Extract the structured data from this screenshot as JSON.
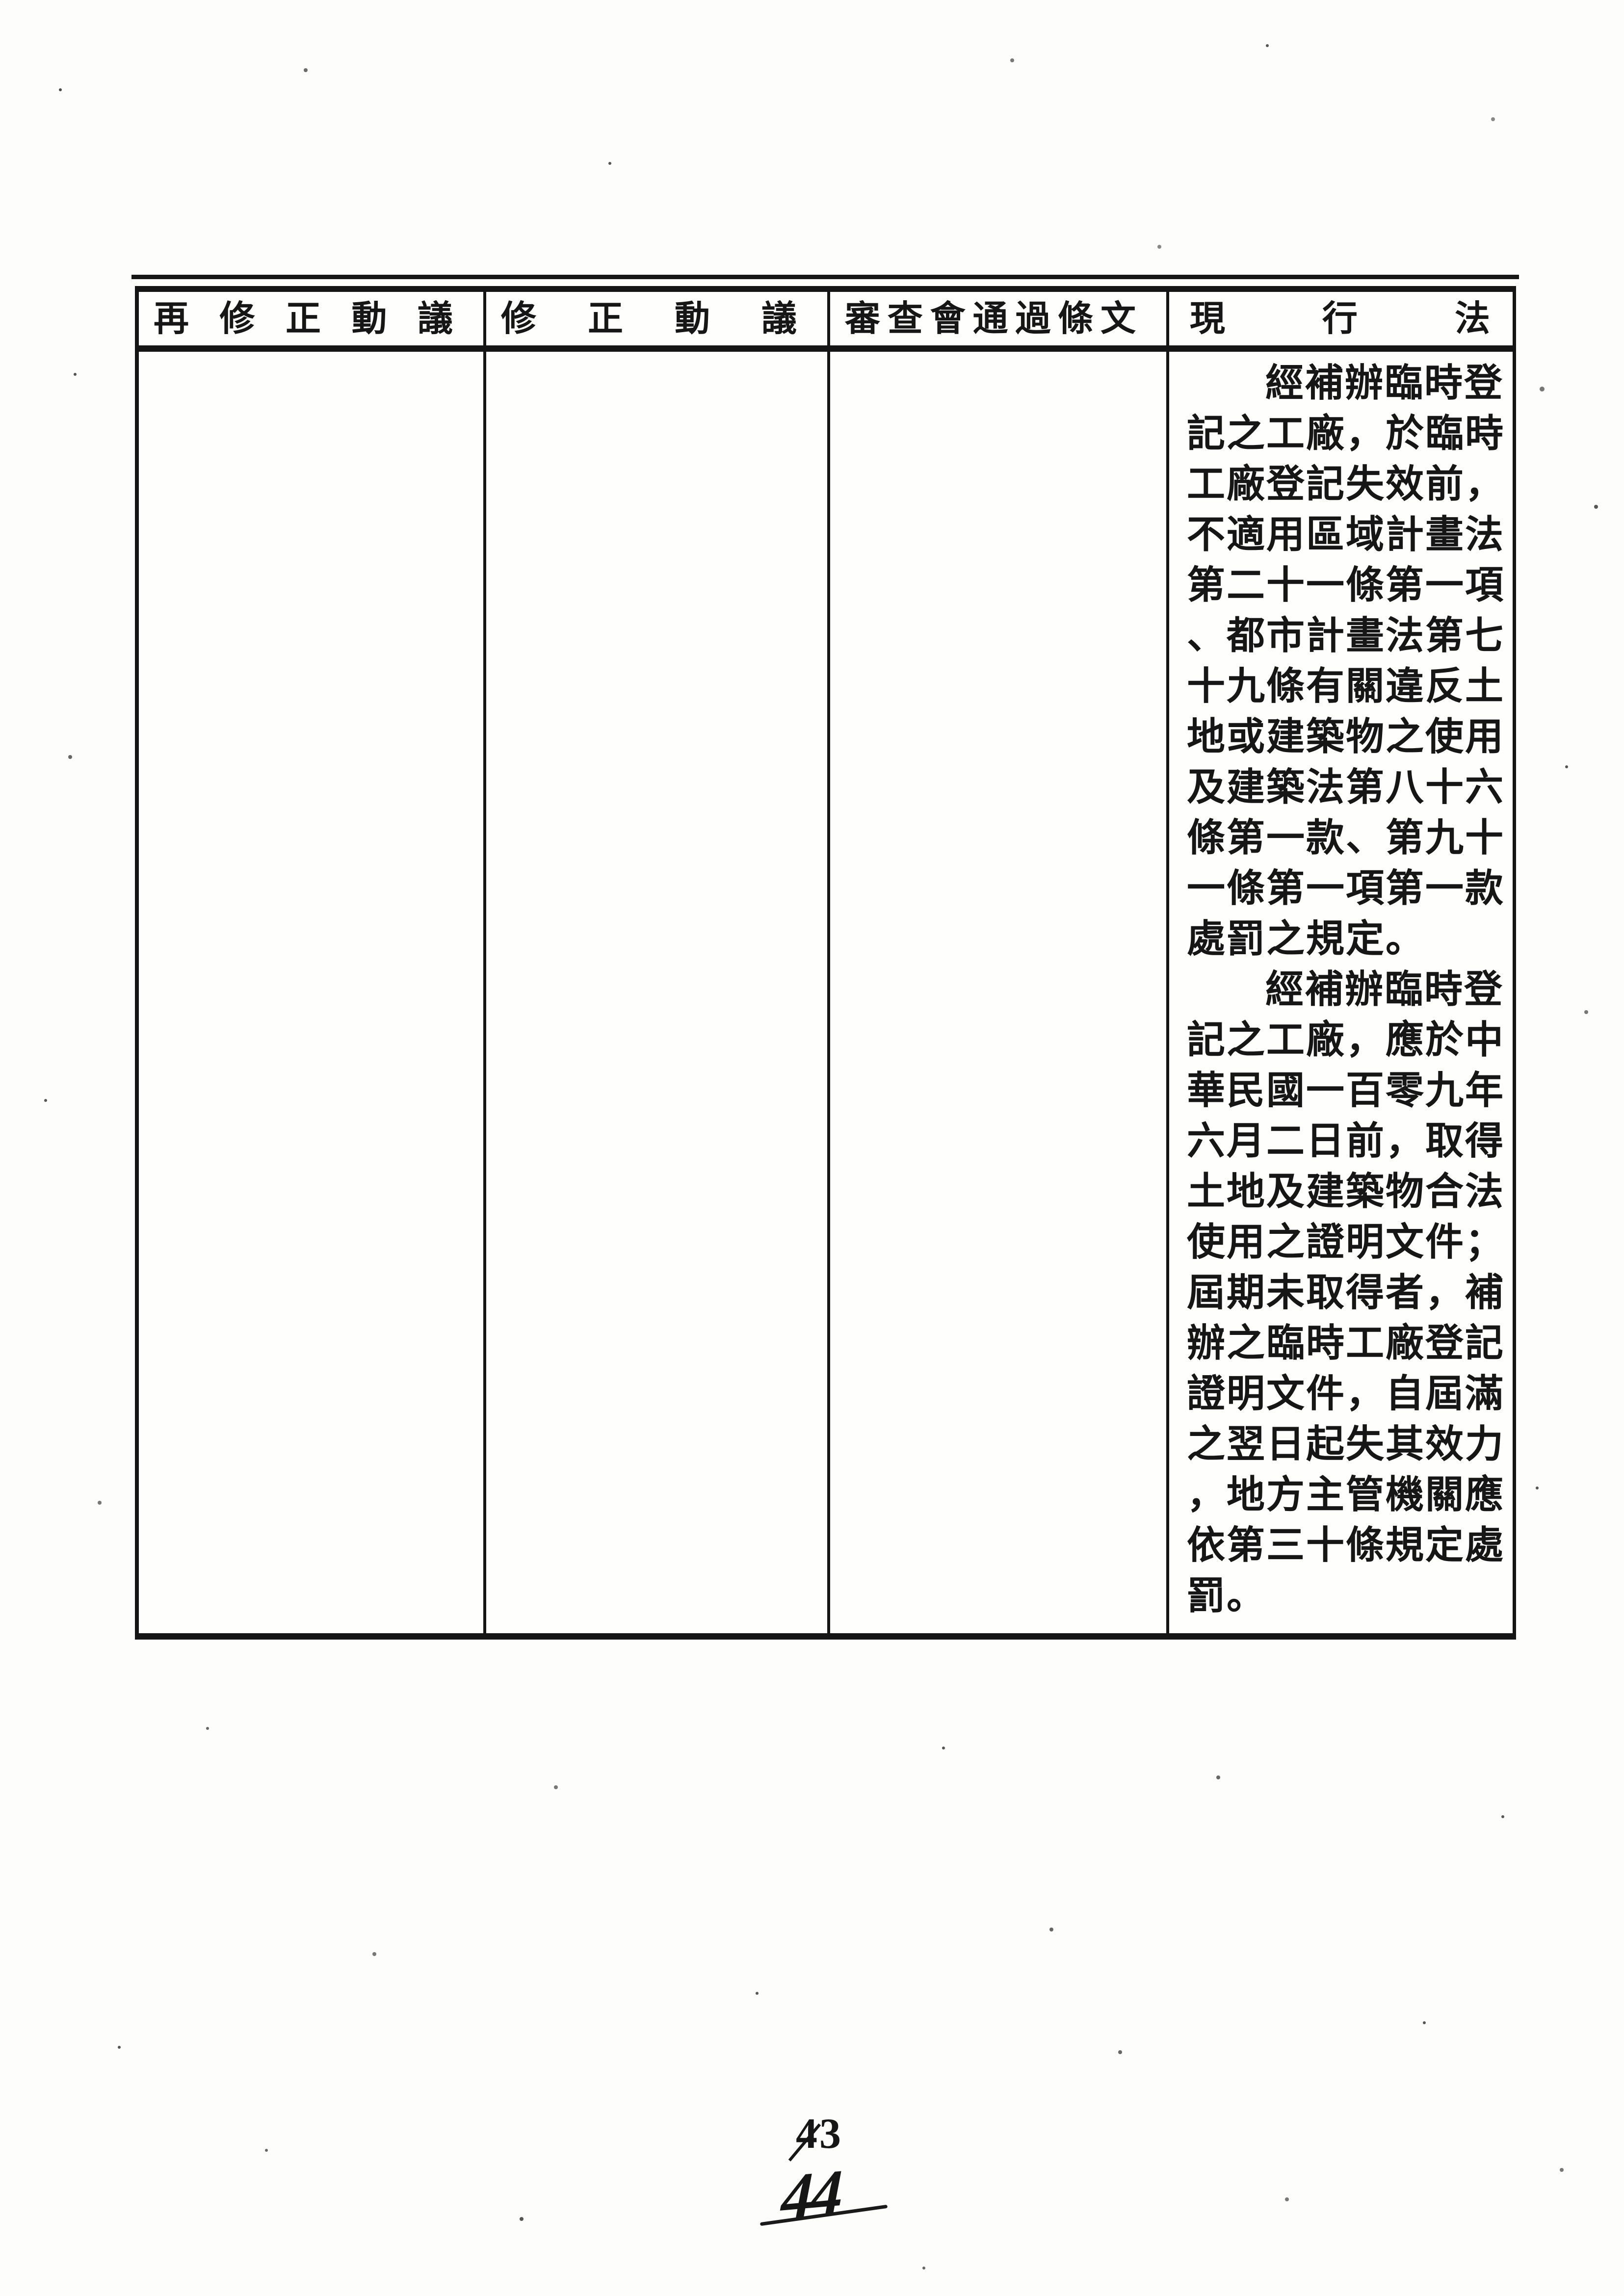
{
  "document": {
    "table": {
      "headers": [
        {
          "id": "re-amendment-motion",
          "label": "再修正動議"
        },
        {
          "id": "amendment-motion",
          "label": "修正動議"
        },
        {
          "id": "committee-passed-text",
          "label": "審查會通過條文"
        },
        {
          "id": "current-law",
          "label": "現行法"
        }
      ],
      "current_law_lines": [
        {
          "indent": true,
          "text": "經補辦臨時登"
        },
        {
          "indent": false,
          "text": "記之工廠，於臨時"
        },
        {
          "indent": false,
          "text": "工廠登記失效前，"
        },
        {
          "indent": false,
          "text": "不適用區域計畫法"
        },
        {
          "indent": false,
          "text": "第二十一條第一項"
        },
        {
          "indent": false,
          "text": "、都市計畫法第七"
        },
        {
          "indent": false,
          "text": "十九條有關違反土"
        },
        {
          "indent": false,
          "text": "地或建築物之使用"
        },
        {
          "indent": false,
          "text": "及建築法第八十六"
        },
        {
          "indent": false,
          "text": "條第一款、第九十"
        },
        {
          "indent": false,
          "text": "一條第一項第一款"
        },
        {
          "indent": false,
          "text": "處罰之規定。"
        },
        {
          "indent": true,
          "text": "經補辦臨時登"
        },
        {
          "indent": false,
          "text": "記之工廠，應於中"
        },
        {
          "indent": false,
          "text": "華民國一百零九年"
        },
        {
          "indent": false,
          "text": "六月二日前，取得"
        },
        {
          "indent": false,
          "text": "土地及建築物合法"
        },
        {
          "indent": false,
          "text": "使用之證明文件；"
        },
        {
          "indent": false,
          "text": "屆期未取得者，補"
        },
        {
          "indent": false,
          "text": "辦之臨時工廠登記"
        },
        {
          "indent": false,
          "text": "證明文件，自屆滿"
        },
        {
          "indent": false,
          "text": "之翌日起失其效力"
        },
        {
          "indent": false,
          "text": "，地方主管機關應"
        },
        {
          "indent": false,
          "text": "依第三十條規定處"
        },
        {
          "indent": false,
          "text": "罰。"
        }
      ]
    },
    "footer": {
      "printed_page_number": "43",
      "handwritten_page_number": "44"
    },
    "colors": {
      "ink": "#161616",
      "paper": "#fdfdfc"
    }
  }
}
